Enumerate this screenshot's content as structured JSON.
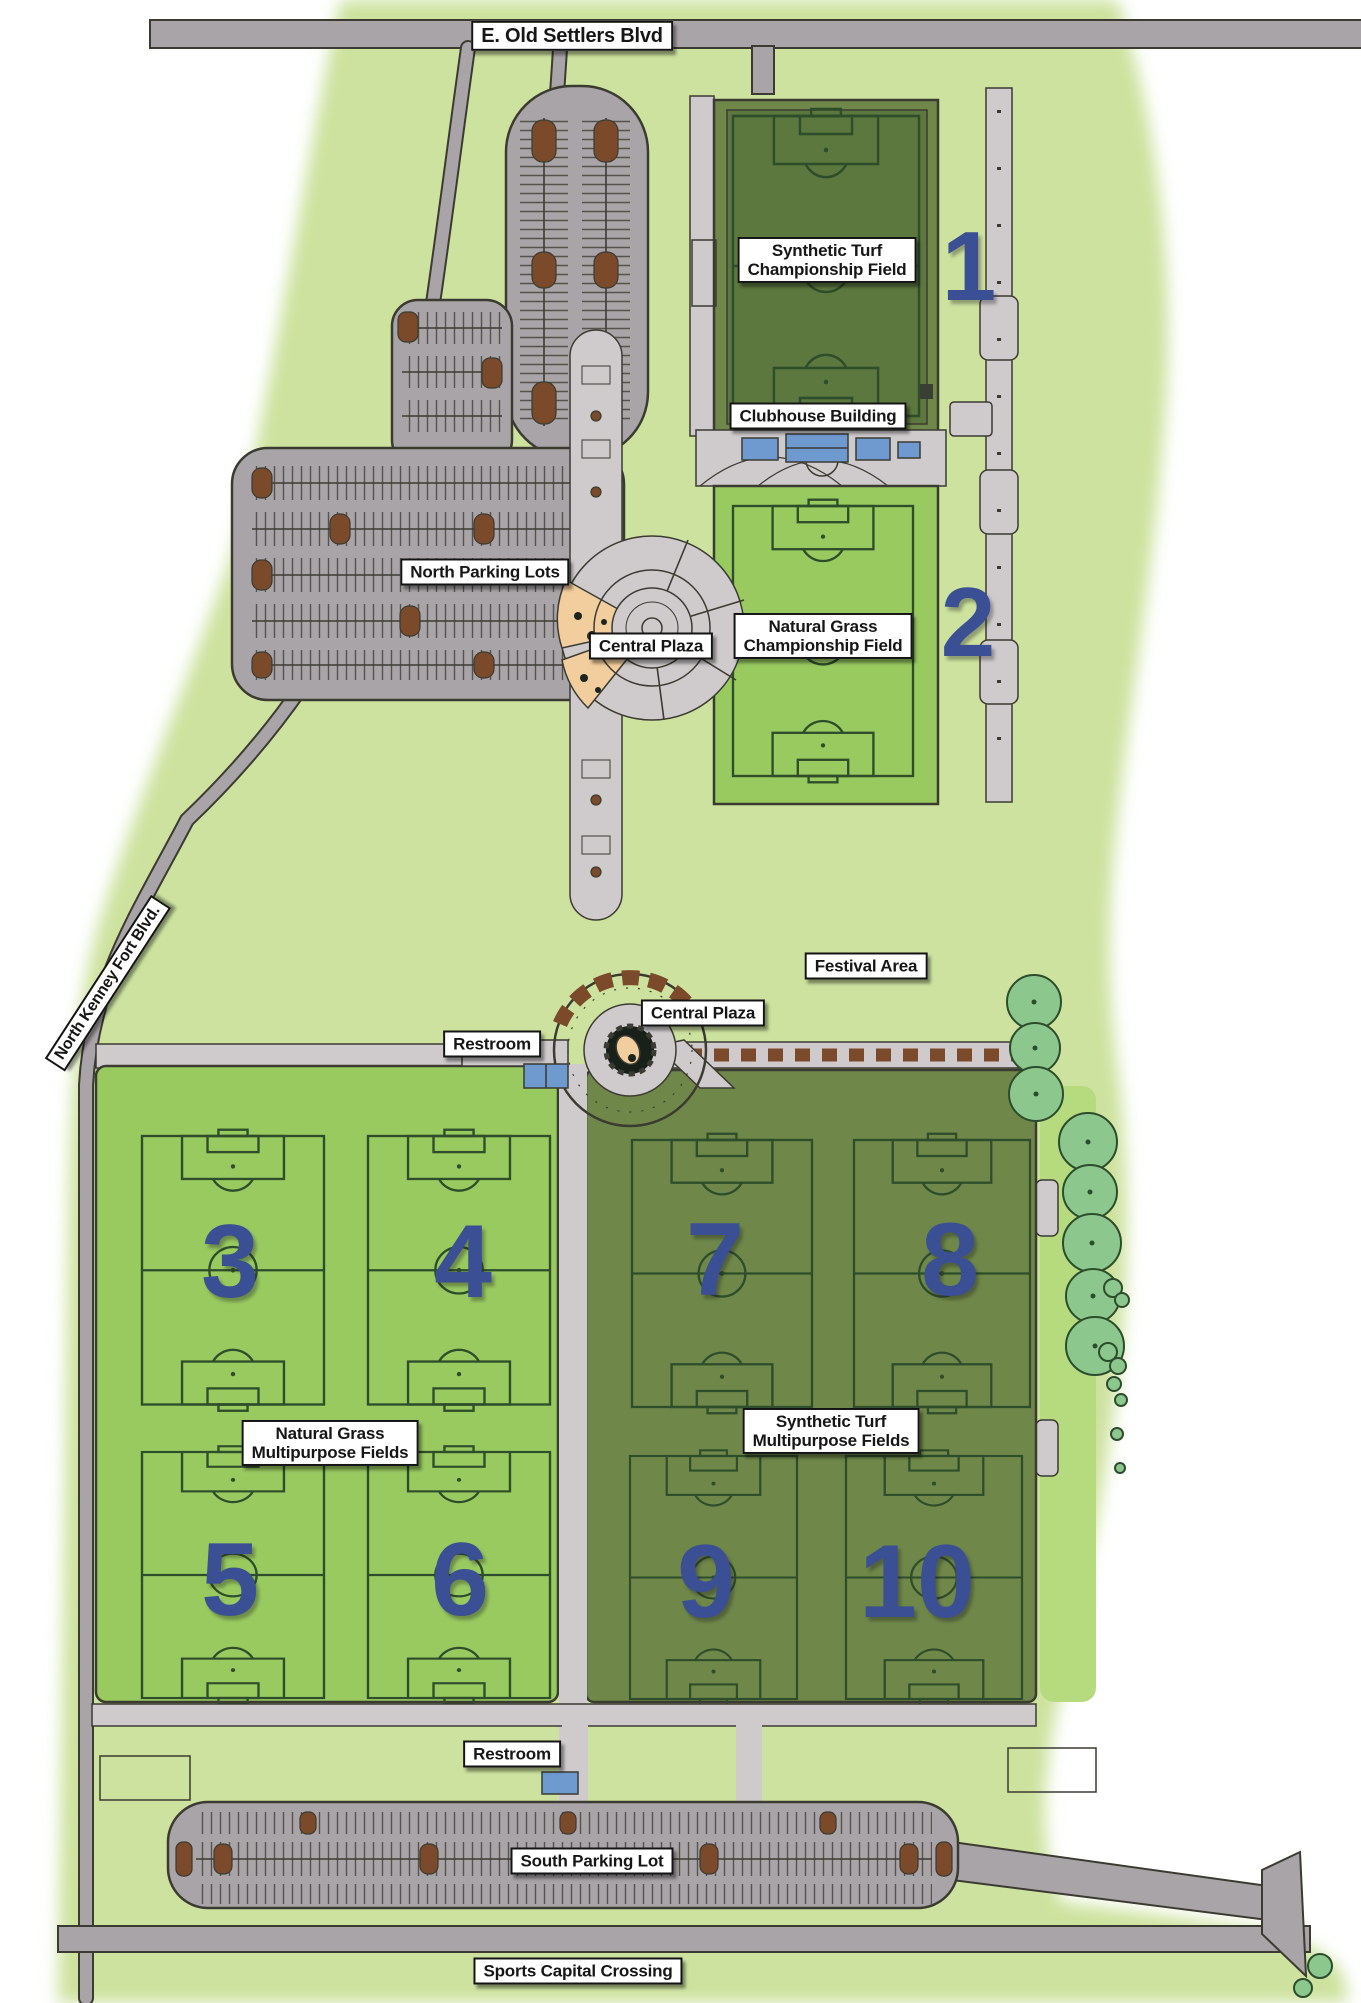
{
  "title": "Sports complex site plan map",
  "colors": {
    "site": "#cde29e",
    "grass": "#99ca60",
    "grassBright": "#b6db7f",
    "turf": "#6f8849",
    "turfDark": "#5d783e",
    "road": "#a9a4a7",
    "walk": "#cfcacc",
    "casing": "#3b3b32",
    "brown": "#7b4a2a",
    "tan": "#f2cd9e",
    "blue": "#3a4f94",
    "building": "#6f9ad0",
    "tree": "#8cc88e",
    "treeOutline": "#2c4c2c",
    "labelBg": "#ffffff",
    "labelText": "#161616",
    "pitchLine": "#2e4d2b"
  },
  "roads": {
    "north": "E. Old Settlers Blvd",
    "west": "North Kenney Fort Blvd.",
    "south": "Sports Capital Crossing"
  },
  "labels": {
    "north_parking": "North Parking Lots",
    "central_plaza_upper": "Central Plaza",
    "central_plaza_lower": "Central Plaza",
    "clubhouse": "Clubhouse Building",
    "festival": "Festival Area",
    "restroom_north": "Restroom",
    "restroom_south": "Restroom",
    "south_parking": "South Parking Lot"
  },
  "field_groups": {
    "synthetic_champ": {
      "line1": "Synthetic Turf",
      "line2": "Championship Field"
    },
    "natural_champ": {
      "line1": "Natural Grass",
      "line2": "Championship Field"
    },
    "natural_multi": {
      "line1": "Natural Grass",
      "line2": "Multipurpose Fields"
    },
    "synthetic_multi": {
      "line1": "Synthetic Turf",
      "line2": "Multipurpose Fields"
    }
  },
  "fields": [
    {
      "number": "1",
      "group": "synthetic-championship"
    },
    {
      "number": "2",
      "group": "natural-championship"
    },
    {
      "number": "3",
      "group": "natural-multipurpose"
    },
    {
      "number": "4",
      "group": "natural-multipurpose"
    },
    {
      "number": "5",
      "group": "natural-multipurpose"
    },
    {
      "number": "6",
      "group": "natural-multipurpose"
    },
    {
      "number": "7",
      "group": "synthetic-multipurpose"
    },
    {
      "number": "8",
      "group": "synthetic-multipurpose"
    },
    {
      "number": "9",
      "group": "synthetic-multipurpose"
    },
    {
      "number": "10",
      "group": "synthetic-multipurpose"
    }
  ]
}
